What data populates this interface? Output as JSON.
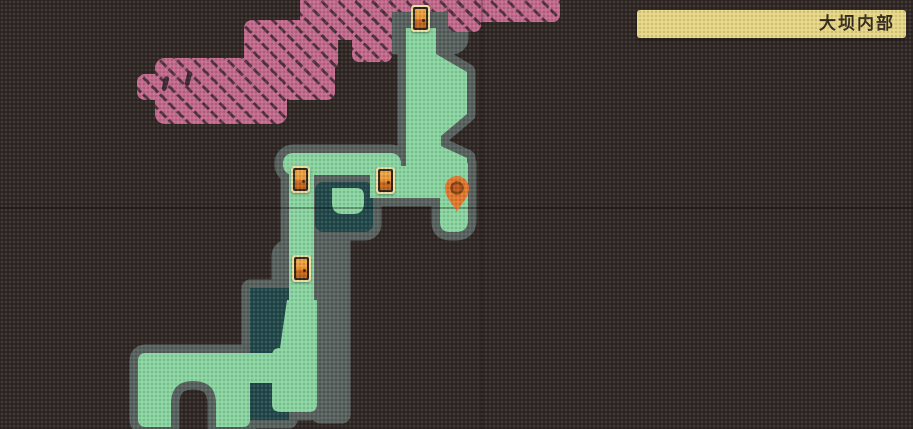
{
  "banner": {
    "title": "大坝内部"
  },
  "colors": {
    "background": "#2e2624",
    "explored_room": "#8ad7a3",
    "room_outline": "#57615f",
    "room_interior_unvisited": "#20484b",
    "unexplored_region": "#c46a8e",
    "hatch_line": "#4d2f3e",
    "banner_bg": "#e9d988",
    "banner_text": "#332a1d",
    "door_frame": "#efe2a2",
    "door_fill": "#ea9434",
    "marker": "#e4782e"
  },
  "map": {
    "doors": [
      {
        "id": "door-top",
        "x": 411,
        "y": 5
      },
      {
        "id": "door-corridor-left",
        "x": 291,
        "y": 166
      },
      {
        "id": "door-corridor-right",
        "x": 376,
        "y": 167
      },
      {
        "id": "door-lower",
        "x": 292,
        "y": 255
      }
    ],
    "marker": {
      "id": "player-location-marker",
      "x": 443,
      "y": 175
    },
    "grid": {
      "vline_x": 481,
      "hline_y": 207
    }
  }
}
